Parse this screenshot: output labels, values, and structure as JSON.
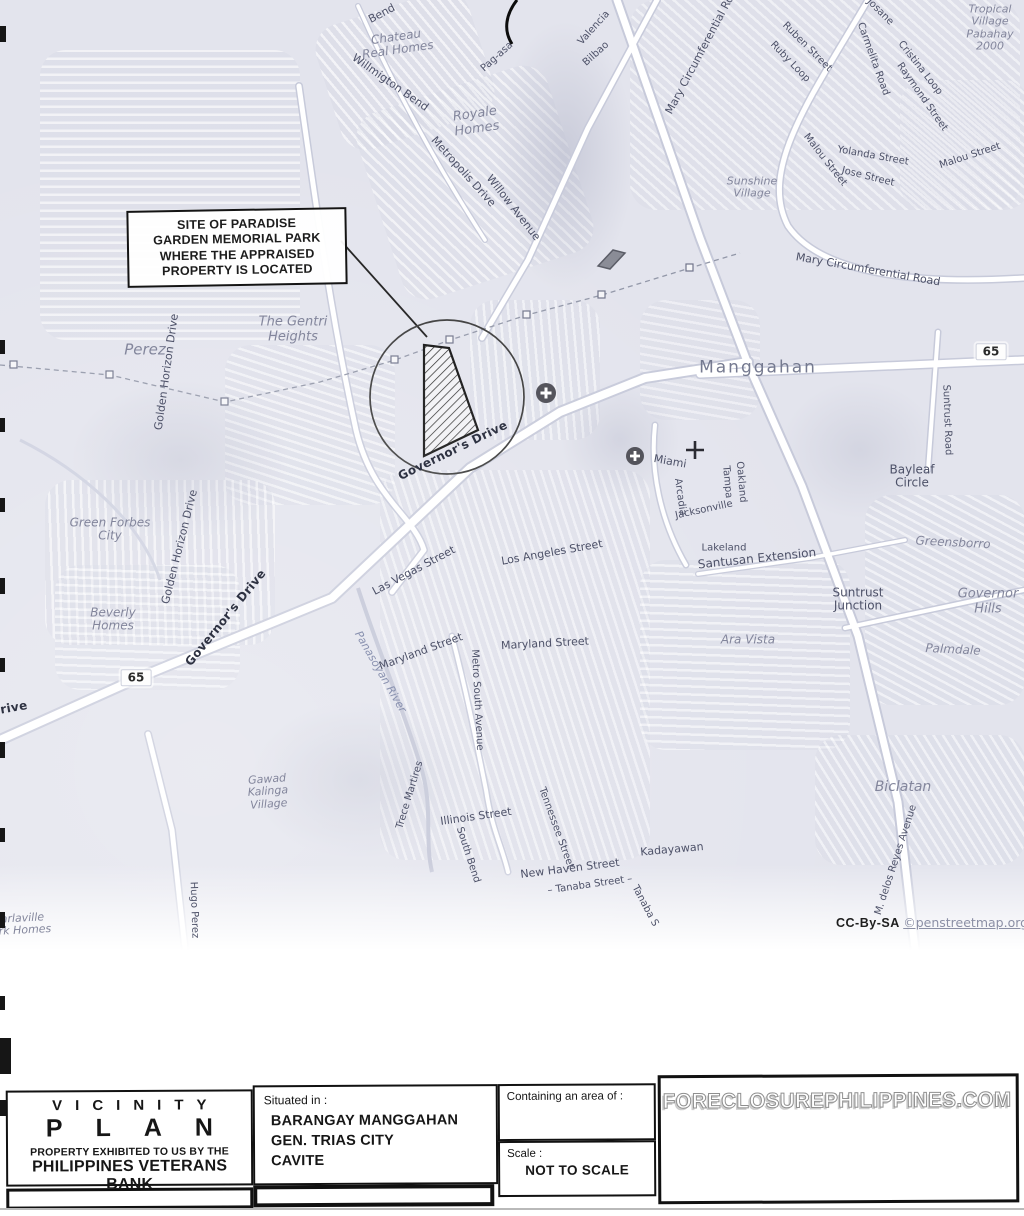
{
  "callout": {
    "lines": [
      "SITE OF PARADISE",
      "GARDEN MEMORIAL PARK",
      "WHERE THE APPRAISED",
      "PROPERTY IS LOCATED"
    ]
  },
  "attribution": {
    "license": "CC-By-SA",
    "link": "©penstreetmap.org"
  },
  "title_block": {
    "vicinity": "VICINITY",
    "plan": "PLAN",
    "property_line1": "PROPERTY EXHIBITED TO US BY THE",
    "property_line2": "PHILIPPINES VETERANS BANK",
    "situated_label": "Situated in :",
    "situated_lines": [
      "BARANGAY MANGGAHAN",
      "GEN. TRIAS CITY",
      "CAVITE"
    ],
    "area_label": "Containing an area of :",
    "scale_label": "Scale :",
    "scale_value": "NOT TO SCALE",
    "watermark": "FORECLOSUREPHILIPPINES.COM"
  },
  "colors": {
    "map_bg": "#e3e4ed",
    "road_fill": "#ffffff",
    "road_casing": "#c7cada",
    "street_label": "#4d5168",
    "place_label": "#83869c",
    "ink": "#141414"
  },
  "map": {
    "highway_refs": [
      "65",
      "65"
    ],
    "labels": [
      {
        "t": "Bend",
        "x": 382,
        "y": 14,
        "r": -28,
        "s": 11,
        "c": "street"
      },
      {
        "t": "Pag-asa",
        "x": 497,
        "y": 57,
        "r": -42,
        "s": 10,
        "c": "street"
      },
      {
        "t": "Chateau|Real Homes",
        "x": 397,
        "y": 44,
        "r": -8,
        "s": 12,
        "c": "place"
      },
      {
        "t": "Willmigton Bend",
        "x": 390,
        "y": 83,
        "r": 35,
        "s": 11,
        "c": "street"
      },
      {
        "t": "Royale|Homes",
        "x": 476,
        "y": 122,
        "r": -8,
        "s": 13,
        "c": "place"
      },
      {
        "t": "Metropolis Drive",
        "x": 463,
        "y": 172,
        "r": 48,
        "s": 11,
        "c": "street"
      },
      {
        "t": "Willow Avenue",
        "x": 513,
        "y": 208,
        "r": 52,
        "s": 11,
        "c": "street"
      },
      {
        "t": "Valencia",
        "x": 594,
        "y": 28,
        "r": -48,
        "s": 10,
        "c": "street"
      },
      {
        "t": "Bilbao",
        "x": 596,
        "y": 54,
        "r": -42,
        "s": 10,
        "c": "street"
      },
      {
        "t": "Mary Circumferential Ro",
        "x": 700,
        "y": 55,
        "r": -62,
        "s": 11,
        "c": "street"
      },
      {
        "t": "Ruben Street",
        "x": 807,
        "y": 47,
        "r": 45,
        "s": 10,
        "c": "street"
      },
      {
        "t": "Ruby Loop",
        "x": 790,
        "y": 62,
        "r": 46,
        "s": 10,
        "c": "street"
      },
      {
        "t": "Josane",
        "x": 880,
        "y": 12,
        "r": 45,
        "s": 10,
        "c": "street"
      },
      {
        "t": "Carmelita Road",
        "x": 873,
        "y": 59,
        "r": 70,
        "s": 10,
        "c": "street"
      },
      {
        "t": "Cristina Loop",
        "x": 920,
        "y": 68,
        "r": 52,
        "s": 10,
        "c": "street"
      },
      {
        "t": "Raymond Street",
        "x": 922,
        "y": 97,
        "r": 55,
        "s": 10,
        "c": "street"
      },
      {
        "t": "Tropical|Village|Pabahay|2000",
        "x": 990,
        "y": 28,
        "r": 0,
        "s": 11,
        "c": "place"
      },
      {
        "t": "Malou Street",
        "x": 825,
        "y": 160,
        "r": 52,
        "s": 10,
        "c": "street"
      },
      {
        "t": "Malou Street",
        "x": 970,
        "y": 156,
        "r": -18,
        "s": 10,
        "c": "street"
      },
      {
        "t": "Yolanda Street",
        "x": 873,
        "y": 156,
        "r": 10,
        "s": 10,
        "c": "street"
      },
      {
        "t": "Jose Street",
        "x": 868,
        "y": 177,
        "r": 14,
        "s": 10,
        "c": "street"
      },
      {
        "t": "Sunshine|Village",
        "x": 752,
        "y": 188,
        "r": 0,
        "s": 11,
        "c": "place"
      },
      {
        "t": "Mary Circumferential Road",
        "x": 868,
        "y": 270,
        "r": 10,
        "s": 11,
        "c": "street"
      },
      {
        "t": "Manggahan",
        "x": 758,
        "y": 368,
        "r": 0,
        "s": 17,
        "c": "place-big"
      },
      {
        "t": "65",
        "x": 991,
        "y": 352,
        "r": 0,
        "s": 12,
        "c": "shield"
      },
      {
        "t": "Suntrust Road",
        "x": 947,
        "y": 420,
        "r": 88,
        "s": 10,
        "c": "street"
      },
      {
        "t": "Bayleaf|Circle",
        "x": 912,
        "y": 477,
        "r": 0,
        "s": 12,
        "c": "street"
      },
      {
        "t": "Greensborro",
        "x": 953,
        "y": 543,
        "r": 3,
        "s": 12,
        "c": "place"
      },
      {
        "t": "Suntrust|Junction",
        "x": 858,
        "y": 600,
        "r": 0,
        "s": 12,
        "c": "street"
      },
      {
        "t": "Governor|Hills",
        "x": 988,
        "y": 602,
        "r": 0,
        "s": 13,
        "c": "place"
      },
      {
        "t": "Palmdale",
        "x": 953,
        "y": 650,
        "r": 3,
        "s": 12,
        "c": "place"
      },
      {
        "t": "Ara Vista",
        "x": 748,
        "y": 640,
        "r": 0,
        "s": 12,
        "c": "place"
      },
      {
        "t": "Miami",
        "x": 670,
        "y": 462,
        "r": 10,
        "s": 11,
        "c": "street"
      },
      {
        "t": "Arcadia",
        "x": 680,
        "y": 497,
        "r": 82,
        "s": 10,
        "c": "street"
      },
      {
        "t": "Tampa",
        "x": 727,
        "y": 482,
        "r": 85,
        "s": 10,
        "c": "street"
      },
      {
        "t": "Oakland",
        "x": 741,
        "y": 482,
        "r": 85,
        "s": 10,
        "c": "street"
      },
      {
        "t": "Jacksonville",
        "x": 704,
        "y": 510,
        "r": -12,
        "s": 10,
        "c": "street"
      },
      {
        "t": "Lakeland",
        "x": 724,
        "y": 548,
        "r": 0,
        "s": 10,
        "c": "street"
      },
      {
        "t": "Santusan Extension",
        "x": 757,
        "y": 559,
        "r": -6,
        "s": 12,
        "c": "street"
      },
      {
        "t": "Perez",
        "x": 145,
        "y": 350,
        "r": 0,
        "s": 15,
        "c": "place"
      },
      {
        "t": "Golden Horizon Drive",
        "x": 167,
        "y": 372,
        "r": -82,
        "s": 11,
        "c": "street"
      },
      {
        "t": "The Gentri|Heights",
        "x": 293,
        "y": 330,
        "r": 0,
        "s": 13,
        "c": "place"
      },
      {
        "t": "Green Forbes|City",
        "x": 110,
        "y": 530,
        "r": 0,
        "s": 12,
        "c": "place"
      },
      {
        "t": "Golden Horizon Drive",
        "x": 180,
        "y": 547,
        "r": -76,
        "s": 11,
        "c": "street"
      },
      {
        "t": "Beverly|Homes",
        "x": 113,
        "y": 620,
        "r": 0,
        "s": 12,
        "c": "place"
      },
      {
        "t": "65",
        "x": 136,
        "y": 678,
        "r": 0,
        "s": 12,
        "c": "shield"
      },
      {
        "t": "Governor's Drive",
        "x": 226,
        "y": 618,
        "r": -51,
        "s": 12,
        "c": "road"
      },
      {
        "t": "Governor's Drive",
        "x": 453,
        "y": 451,
        "r": -26,
        "s": 12,
        "c": "road"
      },
      {
        "t": "rive",
        "x": 14,
        "y": 708,
        "r": -10,
        "s": 12,
        "c": "road"
      },
      {
        "t": "Las Vegas Street",
        "x": 414,
        "y": 571,
        "r": -28,
        "s": 11,
        "c": "street"
      },
      {
        "t": "Los Angeles Street",
        "x": 552,
        "y": 553,
        "r": -10,
        "s": 11,
        "c": "street"
      },
      {
        "t": "Maryland Street",
        "x": 421,
        "y": 652,
        "r": -20,
        "s": 11,
        "c": "street"
      },
      {
        "t": "Maryland Street",
        "x": 545,
        "y": 644,
        "r": -3,
        "s": 11,
        "c": "street"
      },
      {
        "t": "Metro South Avenue",
        "x": 477,
        "y": 700,
        "r": 87,
        "s": 10,
        "c": "street"
      },
      {
        "t": "Panasoyan River",
        "x": 380,
        "y": 672,
        "r": 60,
        "s": 11,
        "c": "river"
      },
      {
        "t": "Trece Martires",
        "x": 410,
        "y": 795,
        "r": -73,
        "s": 10,
        "c": "street"
      },
      {
        "t": "Gawad|Kalinga|Village",
        "x": 268,
        "y": 792,
        "r": -4,
        "s": 11,
        "c": "place"
      },
      {
        "t": "Hugo Perez",
        "x": 194,
        "y": 910,
        "r": 88,
        "s": 10,
        "c": "street"
      },
      {
        "t": "Illinois Street",
        "x": 476,
        "y": 817,
        "r": -8,
        "s": 11,
        "c": "street"
      },
      {
        "t": "South Bend",
        "x": 468,
        "y": 855,
        "r": 72,
        "s": 10,
        "c": "street"
      },
      {
        "t": "Tennessee Street",
        "x": 556,
        "y": 828,
        "r": 70,
        "s": 10,
        "c": "street"
      },
      {
        "t": "New Haven Street",
        "x": 570,
        "y": 869,
        "r": -7,
        "s": 11,
        "c": "street"
      },
      {
        "t": "– Tanaba Street –",
        "x": 590,
        "y": 885,
        "r": -8,
        "s": 10,
        "c": "street"
      },
      {
        "t": "Tanaba S",
        "x": 645,
        "y": 906,
        "r": 62,
        "s": 10,
        "c": "street"
      },
      {
        "t": "Kadayawan",
        "x": 672,
        "y": 850,
        "r": -5,
        "s": 11,
        "c": "street"
      },
      {
        "t": "Biclatan",
        "x": 903,
        "y": 788,
        "r": 0,
        "s": 14,
        "c": "place"
      },
      {
        "t": "M. delos Reyes Avenue",
        "x": 896,
        "y": 860,
        "r": -72,
        "s": 10,
        "c": "street"
      },
      {
        "t": "Marlaville|Park Homes",
        "x": 18,
        "y": 925,
        "r": -3,
        "s": 11,
        "c": "place"
      }
    ]
  }
}
